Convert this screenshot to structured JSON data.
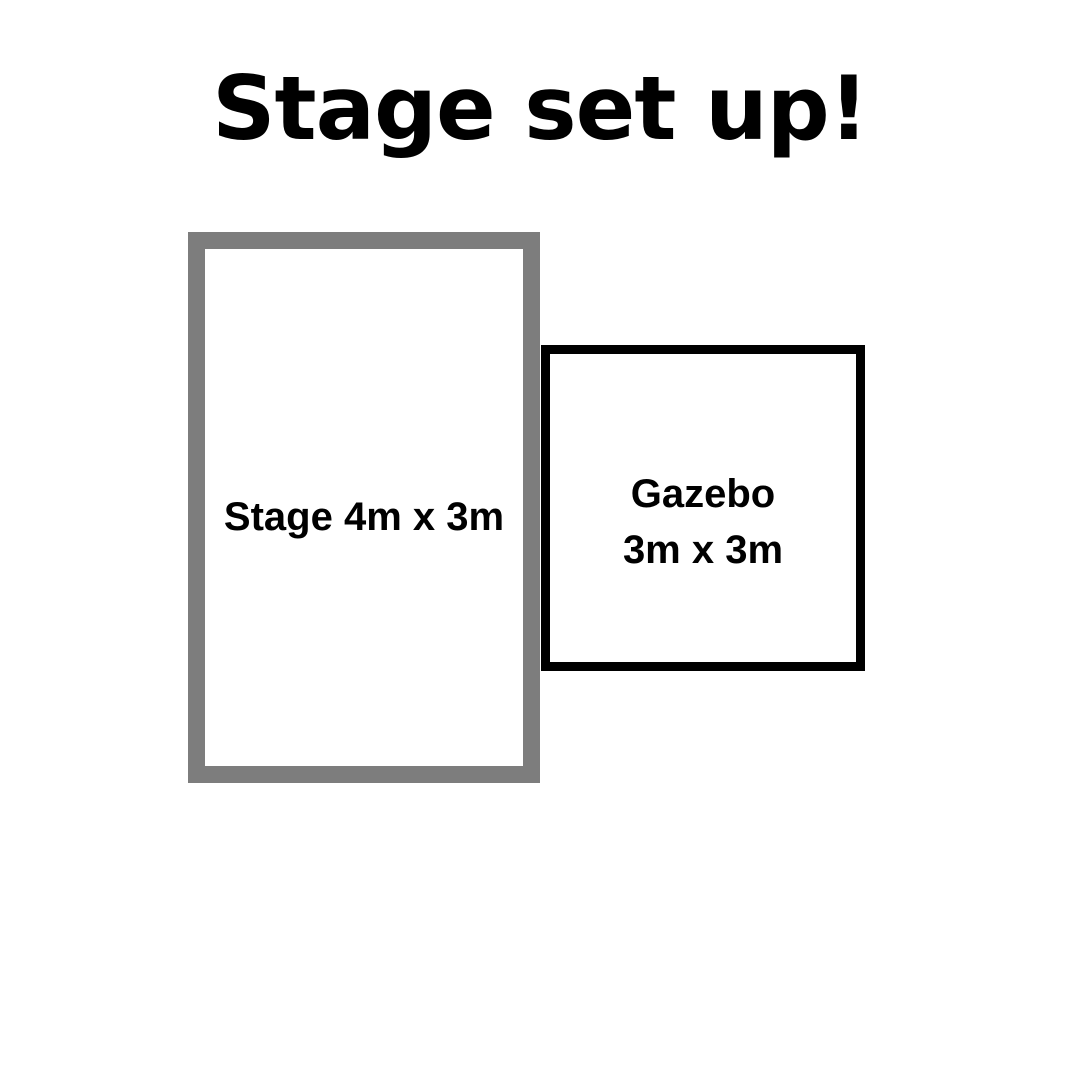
{
  "page": {
    "title": "Stage set up!"
  },
  "diagram": {
    "stage": {
      "label": "Stage 4m x 3m"
    },
    "gazebo": {
      "label_line1": "Gazebo",
      "label_line2": "3m x 3m"
    }
  },
  "colors": {
    "background": "#ffffff",
    "title_text": "#000000",
    "label_text": "#000000",
    "stage_border": "#7d7d7d",
    "gazebo_border": "#000000"
  }
}
